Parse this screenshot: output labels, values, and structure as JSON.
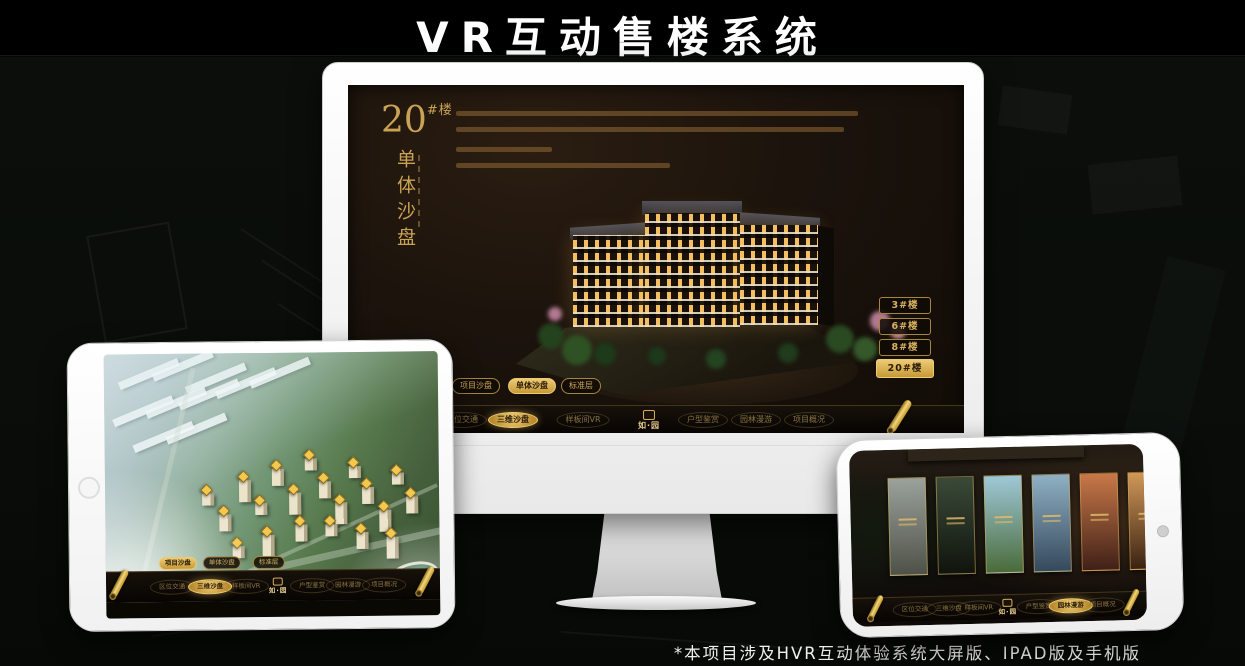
{
  "page": {
    "title": "VR互动售楼系统",
    "footnote": "*本项目涉及HVR互动体验系统大屏版、IPAD版及手机版"
  },
  "colors": {
    "gold": "#d8ae55",
    "gold_deep": "#b98a2e",
    "screen_dark": "#1b130c",
    "title_white": "#ffffff"
  },
  "app": {
    "logo": "如·园",
    "nav_items": [
      {
        "label": "区位交通"
      },
      {
        "label": "三维沙盘"
      },
      {
        "label": "样板间VR"
      },
      {
        "label": "户型鉴赏"
      },
      {
        "label": "园林漫游"
      },
      {
        "label": "项目概况"
      }
    ]
  },
  "monitor": {
    "headline_number": "20",
    "headline_suffix": "#楼",
    "headline_vertical": "单体沙盘",
    "nav_active_index": 1,
    "floor_buttons": [
      {
        "label": "3#楼",
        "active": false
      },
      {
        "label": "6#楼",
        "active": false
      },
      {
        "label": "8#楼",
        "active": false
      },
      {
        "label": "20#楼",
        "active": true
      }
    ],
    "mode_tabs": [
      {
        "label": "项目沙盘",
        "active": false
      },
      {
        "label": "单体沙盘",
        "active": true
      },
      {
        "label": "标准层",
        "active": false
      }
    ]
  },
  "tablet": {
    "nav_active_index": 1,
    "mode_tabs": [
      {
        "label": "项目沙盘",
        "active": true
      },
      {
        "label": "单体沙盘",
        "active": false
      },
      {
        "label": "标准层",
        "active": false
      }
    ],
    "markers": [
      [
        29,
        50
      ],
      [
        34,
        58
      ],
      [
        40,
        45
      ],
      [
        45,
        54
      ],
      [
        50,
        41
      ],
      [
        55,
        50
      ],
      [
        60,
        37
      ],
      [
        64,
        46
      ],
      [
        69,
        54
      ],
      [
        73,
        40
      ],
      [
        77,
        48
      ],
      [
        82,
        57
      ],
      [
        86,
        43
      ],
      [
        57,
        62
      ],
      [
        47,
        66
      ],
      [
        66,
        62
      ],
      [
        75,
        65
      ],
      [
        84,
        67
      ],
      [
        38,
        70
      ],
      [
        90,
        52
      ]
    ],
    "slabs": [
      [
        4,
        6
      ],
      [
        14,
        3
      ],
      [
        24,
        8
      ],
      [
        2,
        20
      ],
      [
        12,
        17
      ],
      [
        22,
        14
      ],
      [
        33,
        10
      ],
      [
        43,
        6
      ],
      [
        8,
        30
      ],
      [
        18,
        27
      ]
    ]
  },
  "phone": {
    "nav_active_index": 4,
    "gallery": [
      {
        "top": "#9aa29b",
        "bottom": "#4e5148"
      },
      {
        "top": "#3a4a38",
        "bottom": "#10140d"
      },
      {
        "top": "#9fc8d8",
        "bottom": "#4a6b3a"
      },
      {
        "top": "#8fb0c4",
        "bottom": "#35495c"
      },
      {
        "top": "#c87848",
        "bottom": "#402018"
      },
      {
        "top": "#d09858",
        "bottom": "#3a2212"
      }
    ]
  }
}
